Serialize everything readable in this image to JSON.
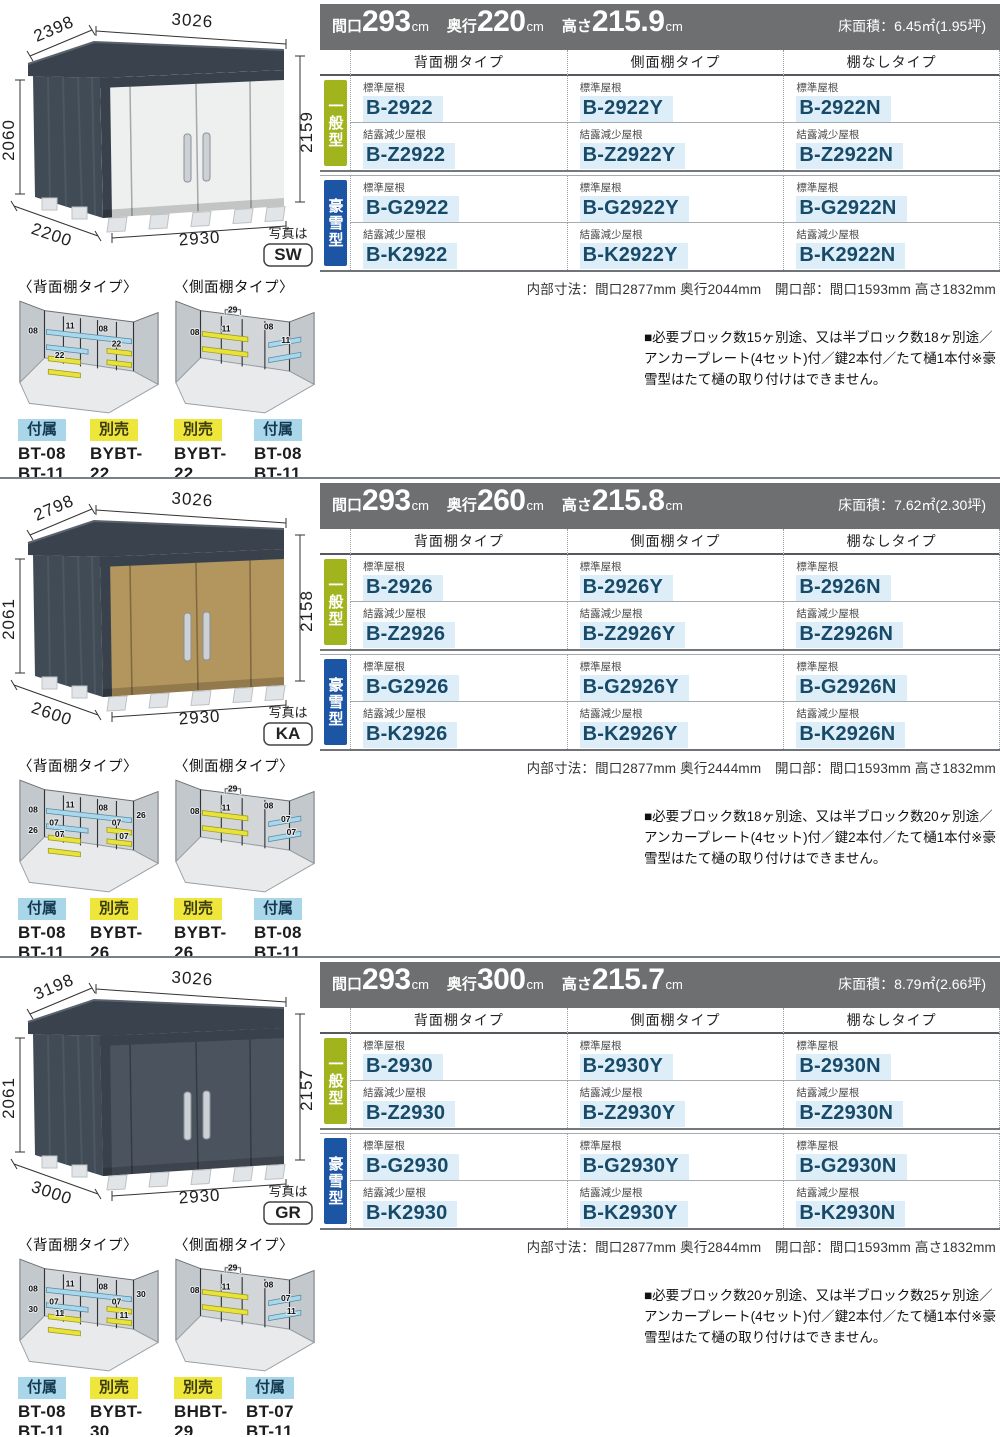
{
  "colors": {
    "accent_green": "#a2b41d",
    "accent_blue": "#1b55a4",
    "model_text": "#174a68",
    "model_highlight": "#ddeef8",
    "chip_blue": "#a9d6e9",
    "chip_yellow": "#efe63b",
    "spec_bar_gray": "#6e6f70",
    "door_sw": "#eef0ef",
    "door_ka": "#b3955e",
    "door_gr": "#4b545e"
  },
  "sections": [
    {
      "header": {
        "w_label": "間口",
        "w_value": "293",
        "w_unit": "cm",
        "d_label": "奥行",
        "d_value": "220",
        "d_unit": "cm",
        "h_label": "高さ",
        "h_value": "215.9",
        "h_unit": "cm",
        "area": "床面積：6.45㎡(1.95坪)"
      },
      "shed": {
        "top_depth": "2398",
        "top_width": "3026",
        "left_height": "2060",
        "right_height": "2159",
        "bottom_depth": "2200",
        "bottom_width": "2930",
        "photo_note": "写真は",
        "photo_code": "SW",
        "door_color": "#eef0ef"
      },
      "table": {
        "col_headers": [
          "背面棚タイプ",
          "側面棚タイプ",
          "棚なしタイプ"
        ],
        "groups": [
          {
            "label": "一般型"
          },
          {
            "label": "豪雪型"
          }
        ],
        "rows": [
          {
            "roof": "標準屋根",
            "models": [
              "B-2922",
              "B-2922Y",
              "B-2922N"
            ]
          },
          {
            "roof": "結露減少屋根",
            "models": [
              "B-Z2922",
              "B-Z2922Y",
              "B-Z2922N"
            ]
          },
          {
            "roof": "標準屋根",
            "models": [
              "B-G2922",
              "B-G2922Y",
              "B-G2922N"
            ]
          },
          {
            "roof": "結露減少屋根",
            "models": [
              "B-K2922",
              "B-K2922Y",
              "B-K2922N"
            ]
          }
        ]
      },
      "inner_dims": "内部寸法：間口2877mm 奥行2044mm　開口部：間口1593mm 高さ1832mm",
      "note": "■必要ブロック数15ヶ別途、又は半ブロック数18ヶ別途／アンカープレート(4セット)付／鍵2本付／たて樋1本付※豪雪型はたて樋の取り付けはできません。",
      "diagrams": [
        {
          "title": "〈背面棚タイプ〉",
          "labels": [
            "08",
            "11",
            "08",
            "",
            "",
            "22",
            "22",
            "",
            ""
          ],
          "chips": [
            {
              "label": "付属",
              "type": "blue",
              "parts": "BT-08\nBT-11"
            },
            {
              "label": "別売",
              "type": "yellow",
              "parts": "BYBT-22"
            }
          ]
        },
        {
          "title": "〈側面棚タイプ〉",
          "labels": [
            "┌29┐",
            "08",
            "11",
            "08",
            "11",
            ""
          ],
          "chips": [
            {
              "label": "別売",
              "type": "yellow",
              "parts": "BYBT-22"
            },
            {
              "label": "付属",
              "type": "blue",
              "parts": "BT-08\nBT-11"
            }
          ]
        }
      ]
    },
    {
      "header": {
        "w_label": "間口",
        "w_value": "293",
        "w_unit": "cm",
        "d_label": "奥行",
        "d_value": "260",
        "d_unit": "cm",
        "h_label": "高さ",
        "h_value": "215.8",
        "h_unit": "cm",
        "area": "床面積：7.62㎡(2.30坪)"
      },
      "shed": {
        "top_depth": "2798",
        "top_width": "3026",
        "left_height": "2061",
        "right_height": "2158",
        "bottom_depth": "2600",
        "bottom_width": "2930",
        "photo_note": "写真は",
        "photo_code": "KA",
        "door_color": "#b3955e"
      },
      "table": {
        "col_headers": [
          "背面棚タイプ",
          "側面棚タイプ",
          "棚なしタイプ"
        ],
        "groups": [
          {
            "label": "一般型"
          },
          {
            "label": "豪雪型"
          }
        ],
        "rows": [
          {
            "roof": "標準屋根",
            "models": [
              "B-2926",
              "B-2926Y",
              "B-2926N"
            ]
          },
          {
            "roof": "結露減少屋根",
            "models": [
              "B-Z2926",
              "B-Z2926Y",
              "B-Z2926N"
            ]
          },
          {
            "roof": "標準屋根",
            "models": [
              "B-G2926",
              "B-G2926Y",
              "B-G2926N"
            ]
          },
          {
            "roof": "結露減少屋根",
            "models": [
              "B-K2926",
              "B-K2926Y",
              "B-K2926N"
            ]
          }
        ]
      },
      "inner_dims": "内部寸法：間口2877mm 奥行2444mm　開口部：間口1593mm 高さ1832mm",
      "note": "■必要ブロック数18ヶ別途、又は半ブロック数20ヶ別途／アンカープレート(4セット)付／鍵2本付／たて樋1本付※豪雪型はたて樋の取り付けはできません。",
      "diagrams": [
        {
          "title": "〈背面棚タイプ〉",
          "labels": [
            "08",
            "11",
            "08",
            "07",
            "26",
            "07",
            "07",
            "26",
            "07"
          ],
          "chips": [
            {
              "label": "付属",
              "type": "blue",
              "parts": "BT-08\nBT-11"
            },
            {
              "label": "別売",
              "type": "yellow",
              "parts": "BYBT-26"
            }
          ]
        },
        {
          "title": "〈側面棚タイプ〉",
          "labels": [
            "┌29┐",
            "08",
            "11",
            "08",
            "07",
            "07"
          ],
          "chips": [
            {
              "label": "別売",
              "type": "yellow",
              "parts": "BYBT-26"
            },
            {
              "label": "付属",
              "type": "blue",
              "parts": "BT-08\nBT-11"
            }
          ]
        }
      ]
    },
    {
      "header": {
        "w_label": "間口",
        "w_value": "293",
        "w_unit": "cm",
        "d_label": "奥行",
        "d_value": "300",
        "d_unit": "cm",
        "h_label": "高さ",
        "h_value": "215.7",
        "h_unit": "cm",
        "area": "床面積：8.79㎡(2.66坪)"
      },
      "shed": {
        "top_depth": "3198",
        "top_width": "3026",
        "left_height": "2061",
        "right_height": "2157",
        "bottom_depth": "3000",
        "bottom_width": "2930",
        "photo_note": "写真は",
        "photo_code": "GR",
        "door_color": "#4b545e"
      },
      "table": {
        "col_headers": [
          "背面棚タイプ",
          "側面棚タイプ",
          "棚なしタイプ"
        ],
        "groups": [
          {
            "label": "一般型"
          },
          {
            "label": "豪雪型"
          }
        ],
        "rows": [
          {
            "roof": "標準屋根",
            "models": [
              "B-2930",
              "B-2930Y",
              "B-2930N"
            ]
          },
          {
            "roof": "結露減少屋根",
            "models": [
              "B-Z2930",
              "B-Z2930Y",
              "B-Z2930N"
            ]
          },
          {
            "roof": "標準屋根",
            "models": [
              "B-G2930",
              "B-G2930Y",
              "B-G2930N"
            ]
          },
          {
            "roof": "結露減少屋根",
            "models": [
              "B-K2930",
              "B-K2930Y",
              "B-K2930N"
            ]
          }
        ]
      },
      "inner_dims": "内部寸法：間口2877mm 奥行2844mm　開口部：間口1593mm 高さ1832mm",
      "note": "■必要ブロック数20ヶ別途、又は半ブロック数25ヶ別途／アンカープレート(4セット)付／鍵2本付／たて樋1本付※豪雪型はたて樋の取り付けはできません。",
      "diagrams": [
        {
          "title": "〈背面棚タイプ〉",
          "labels": [
            "08",
            "11",
            "08",
            "07",
            "30",
            "11",
            "07",
            "30",
            "11"
          ],
          "chips": [
            {
              "label": "付属",
              "type": "blue",
              "parts": "BT-08\nBT-11"
            },
            {
              "label": "別売",
              "type": "yellow",
              "parts": "BYBT-30"
            }
          ]
        },
        {
          "title": "〈側面棚タイプ〉",
          "labels": [
            "┌29┐",
            "08",
            "11",
            "08",
            "07",
            "11"
          ],
          "chips": [
            {
              "label": "別売",
              "type": "yellow",
              "parts": "BHBT-29"
            },
            {
              "label": "付属",
              "type": "blue",
              "parts": "BT-07 BT-11\nBT-08"
            }
          ]
        }
      ]
    }
  ]
}
